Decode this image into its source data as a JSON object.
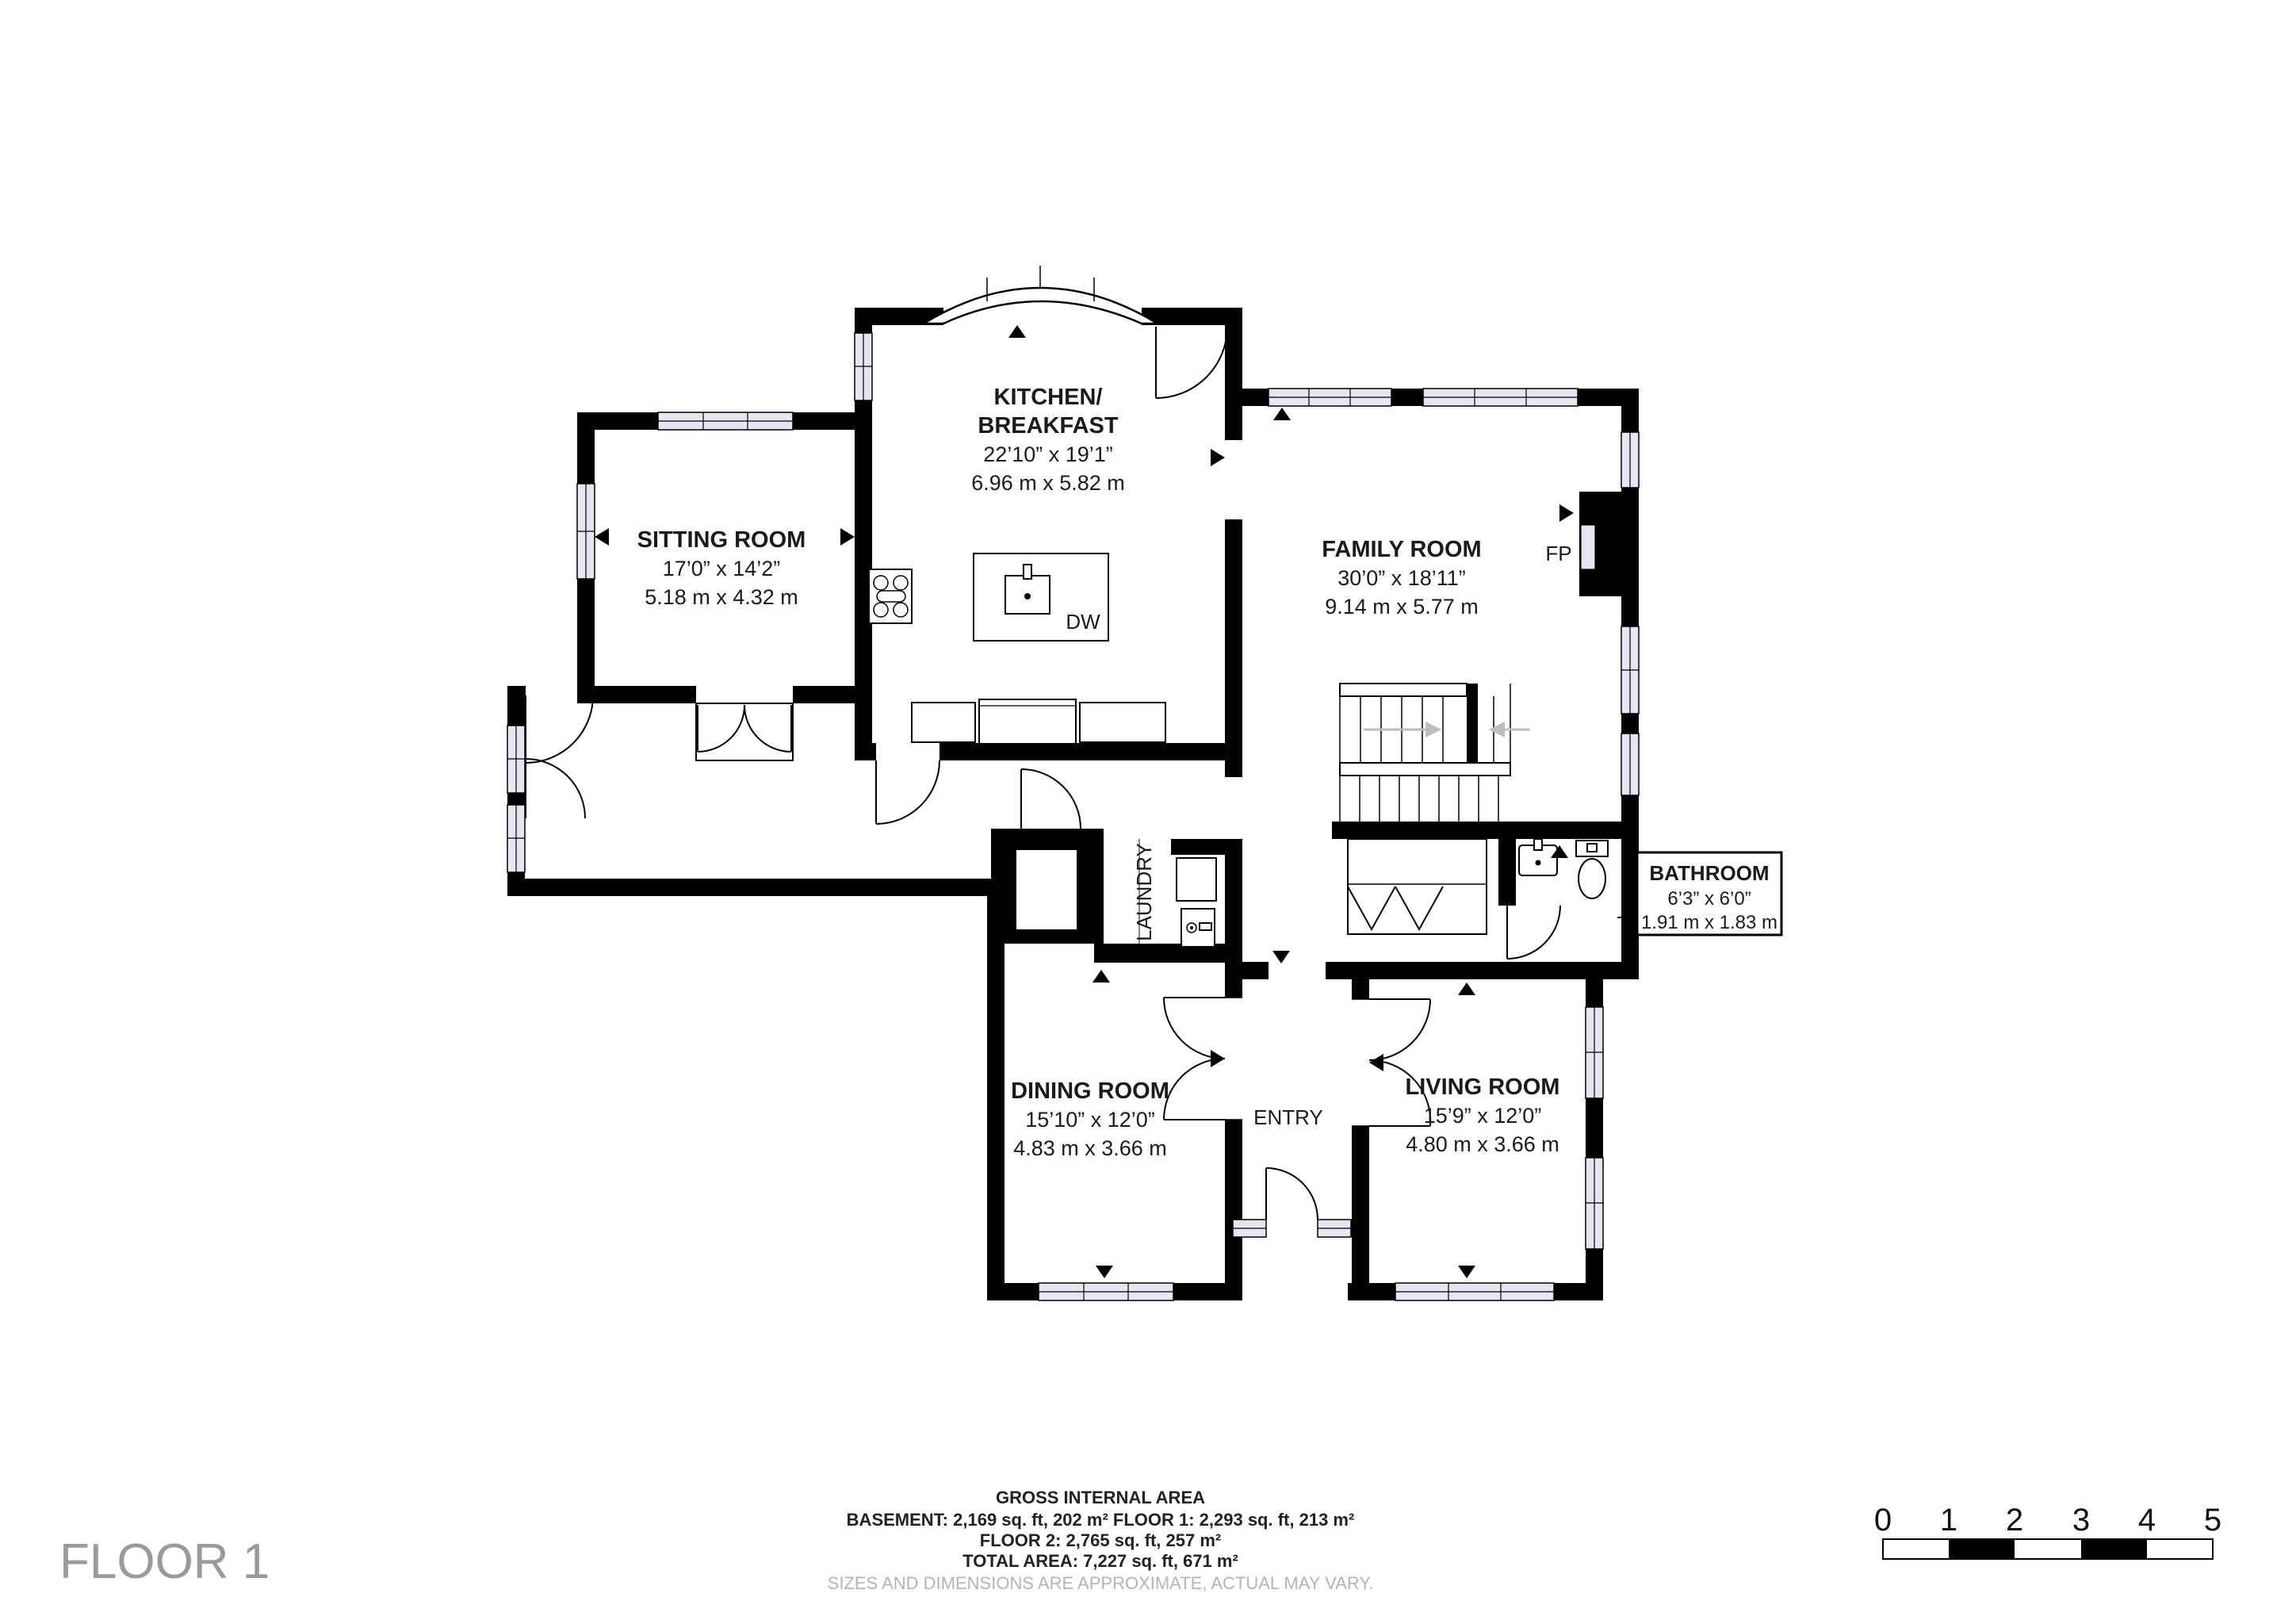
{
  "title": {
    "floor": "FLOOR 1"
  },
  "rooms": {
    "kitchen": {
      "name_line1": "KITCHEN/",
      "name_line2": "BREAKFAST",
      "imperial": "22’10” x 19’1”",
      "metric": "6.96 m x 5.82 m"
    },
    "sitting": {
      "name": "SITTING ROOM",
      "imperial": "17’0” x 14’2”",
      "metric": "5.18 m x 4.32 m"
    },
    "family": {
      "name": "FAMILY ROOM",
      "imperial": "30’0” x 18’11”",
      "metric": "9.14 m x 5.77 m"
    },
    "dining": {
      "name": "DINING ROOM",
      "imperial": "15’10” x 12’0”",
      "metric": "4.83 m x 3.66 m"
    },
    "living": {
      "name": "LIVING ROOM",
      "imperial": "15’9” x 12’0”",
      "metric": "4.80 m x 3.66 m"
    },
    "bathroom": {
      "name": "BATHROOM",
      "imperial": "6’3” x 6’0”",
      "metric": "1.91 m x 1.83 m"
    },
    "entry": {
      "name": "ENTRY"
    },
    "laundry": {
      "name": "LAUNDRY"
    }
  },
  "annotations": {
    "fireplace": "FP",
    "dishwasher": "DW"
  },
  "footer": {
    "title": "GROSS INTERNAL AREA",
    "line1": "BASEMENT: 2,169 sq. ft, 202 m²  FLOOR 1: 2,293 sq. ft, 213 m²",
    "line2": "FLOOR 2: 2,765 sq. ft, 257 m²",
    "line3": "TOTAL AREA: 7,227 sq. ft, 671 m²",
    "disclaimer": "SIZES AND DIMENSIONS ARE APPROXIMATE, ACTUAL MAY VARY."
  },
  "scale_bar": {
    "ticks": [
      "0",
      "1",
      "2",
      "3",
      "4",
      "5"
    ]
  },
  "colors": {
    "wall": "#000000",
    "window_glass": "#e6e6f2",
    "text": "#1a1a1a",
    "muted_text": "#9a9a9a",
    "disclaimer_text": "#b4b4b4",
    "stair_arrow": "#bdbdbd"
  }
}
